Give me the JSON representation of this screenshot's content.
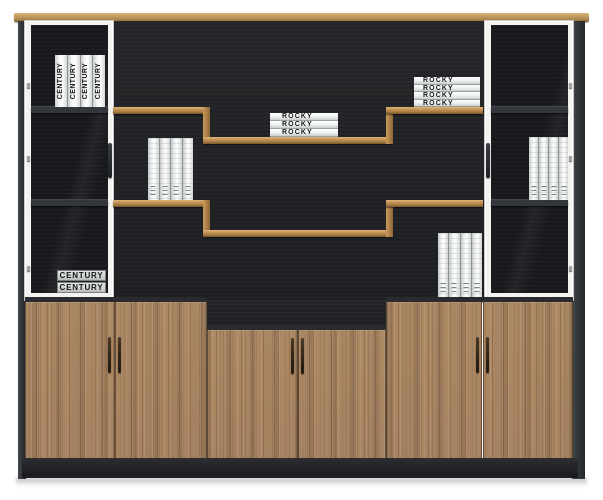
{
  "product": {
    "name": "Walnut and black office display bookcase",
    "style": "Two glass-door side cabinets, stepped open shelving, six lower wood doors"
  },
  "colors": {
    "wood_top": "#bb9259",
    "wood_shelf": "#a87c44",
    "wood_door": "#a17e5e",
    "back_black": "#1f2124",
    "frame_white": "#f3f3f1",
    "plinth": "#202225",
    "handle_dark": "#2c2115",
    "background": "#ffffff"
  },
  "books": {
    "century_upright": {
      "label": "CENTURY",
      "count": 4,
      "location": "left glass cabinet, top shelf"
    },
    "century_flat": {
      "label": "CENTURY",
      "count": 2,
      "location": "left glass cabinet, bottom"
    },
    "rocky_flat_low": {
      "label": "ROCKY",
      "count": 3,
      "location": "middle lower stepped shelf"
    },
    "rocky_flat_high": {
      "label": "ROCKY",
      "count": 4,
      "location": "middle upper right shelf"
    },
    "binders_left": {
      "label": "",
      "count": 4,
      "location": "middle left second shelf"
    },
    "binders_center": {
      "label": "",
      "count": 4,
      "location": "middle right bottom surface"
    },
    "binders_right": {
      "label": "",
      "count": 4,
      "location": "right glass cabinet, middle shelf"
    }
  }
}
